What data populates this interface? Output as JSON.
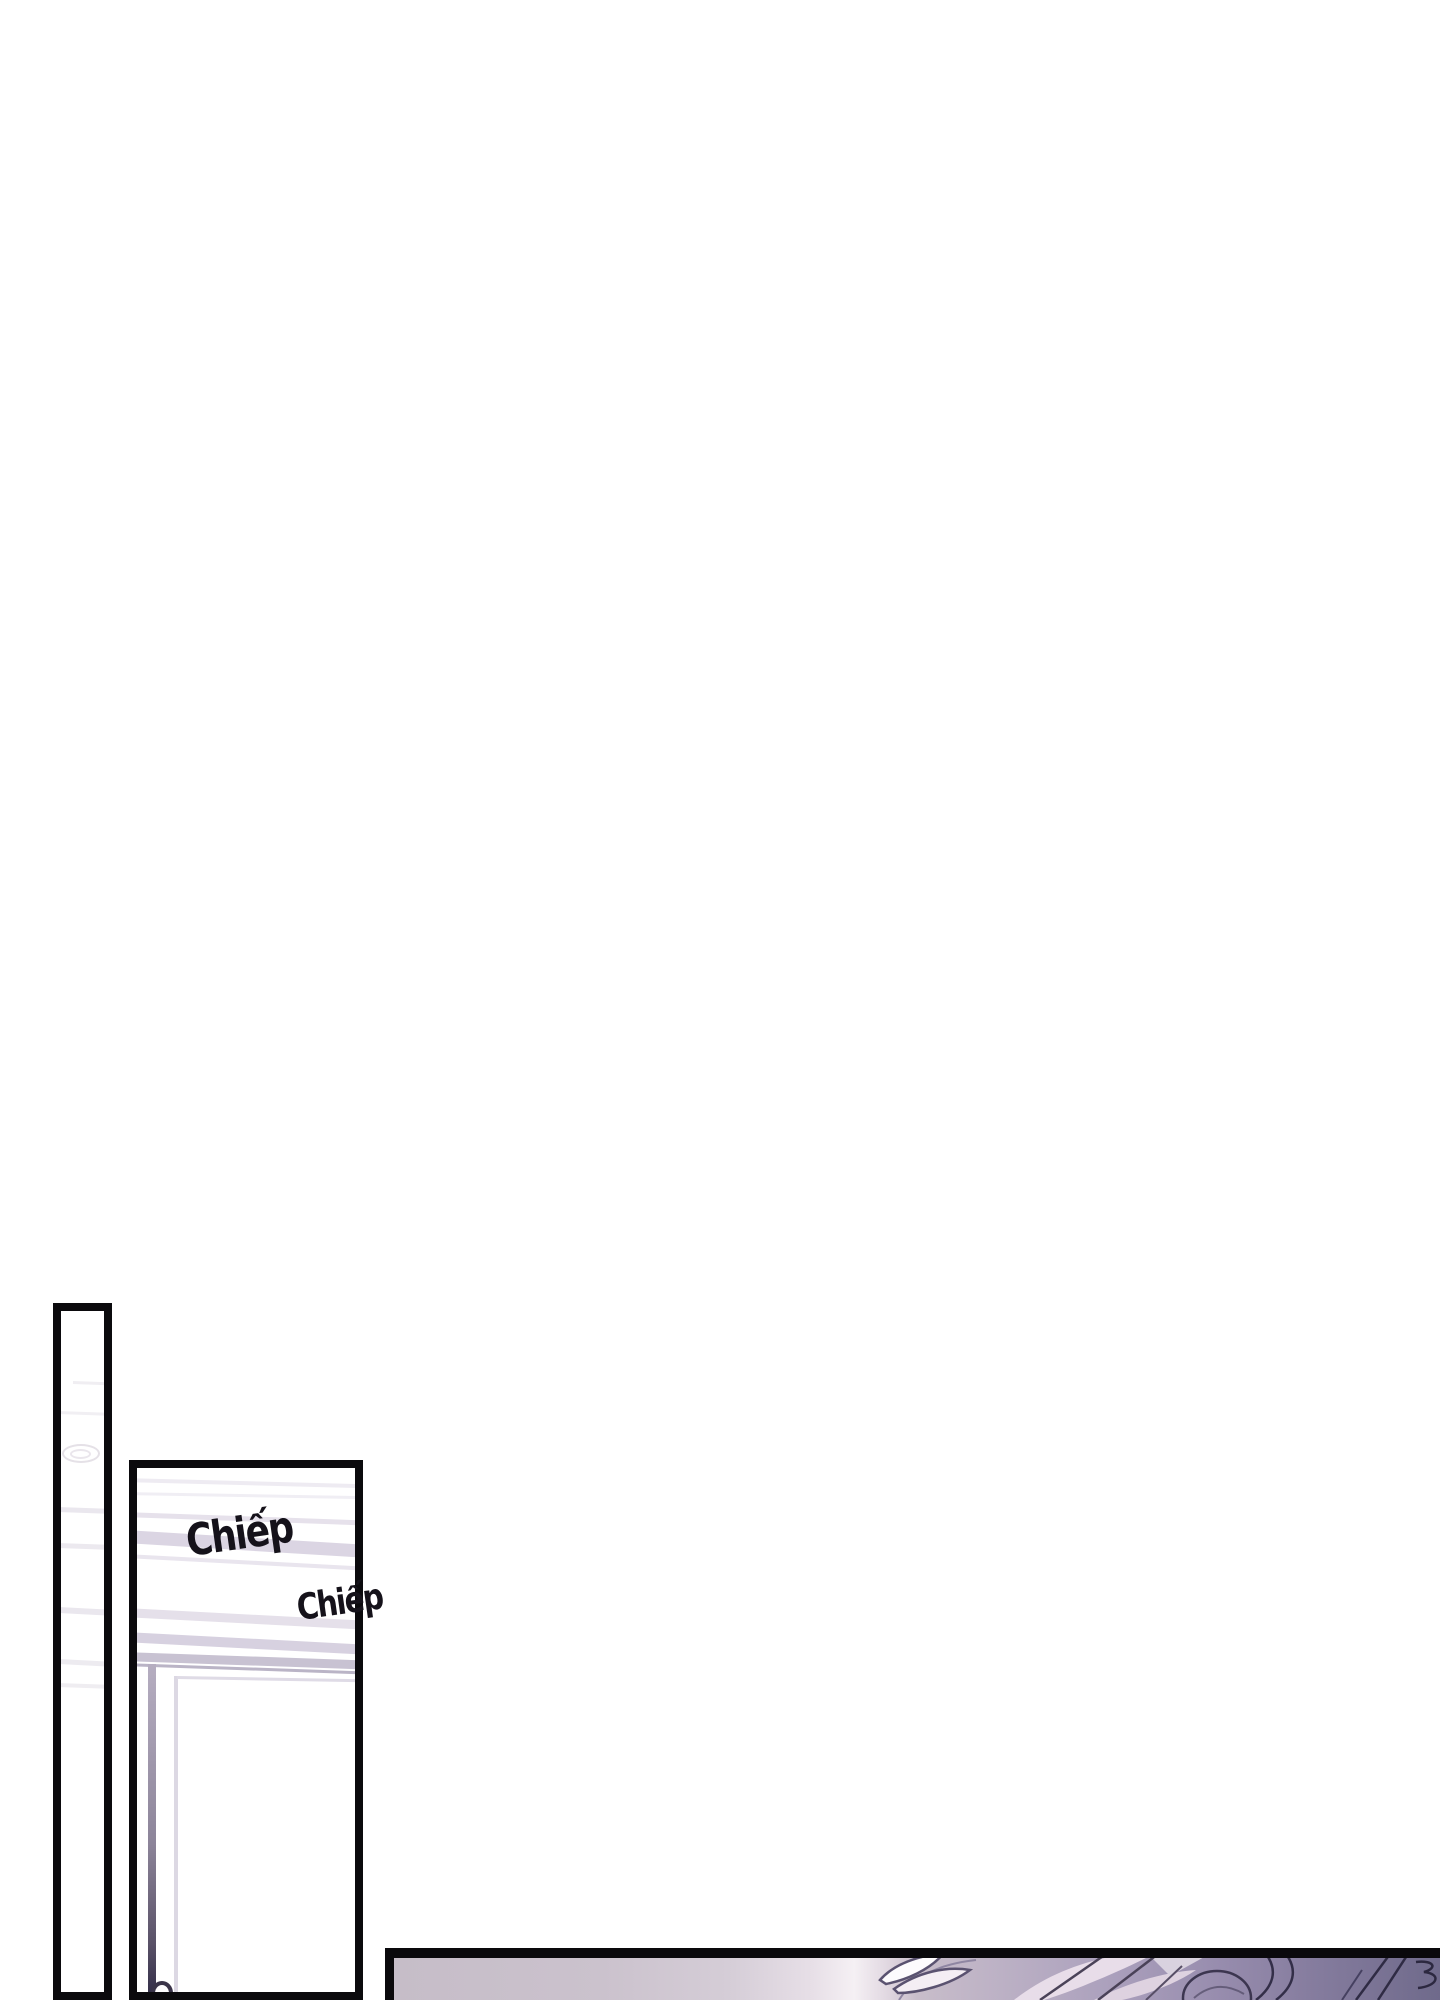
{
  "page": {
    "type": "comic-page",
    "background_color": "#ffffff",
    "ink_color": "#0b0a0d"
  },
  "panels": [
    {
      "id": "tall-wall-panel",
      "content": "narrow vertical panel, blank wall with faint wood grain knot"
    },
    {
      "id": "door-panel",
      "content": "panel with striped wall and white door with handle"
    },
    {
      "id": "hair-closeup-panel",
      "content": "wide bottom panel, purple hair close-up with bright glow"
    }
  ],
  "sfx": [
    {
      "text": "Chiếp"
    },
    {
      "text": "Chiếp"
    }
  ],
  "colors": {
    "panel_border": "#0b0a0d",
    "wall_stripe_light": "#eeebf2",
    "wall_stripe": "#dbd5e3",
    "wall_molding": "#c8c2d2",
    "door_frame_dark": "#35304a",
    "door_edge": "#dcd8e3",
    "handle_outline": "#3a3449",
    "hair_glow": "#f5f0f4",
    "hair_lavender": "#c6bdc8",
    "hair_purple_dark": "#6f6a8b",
    "hair_line": "#3c3650"
  }
}
